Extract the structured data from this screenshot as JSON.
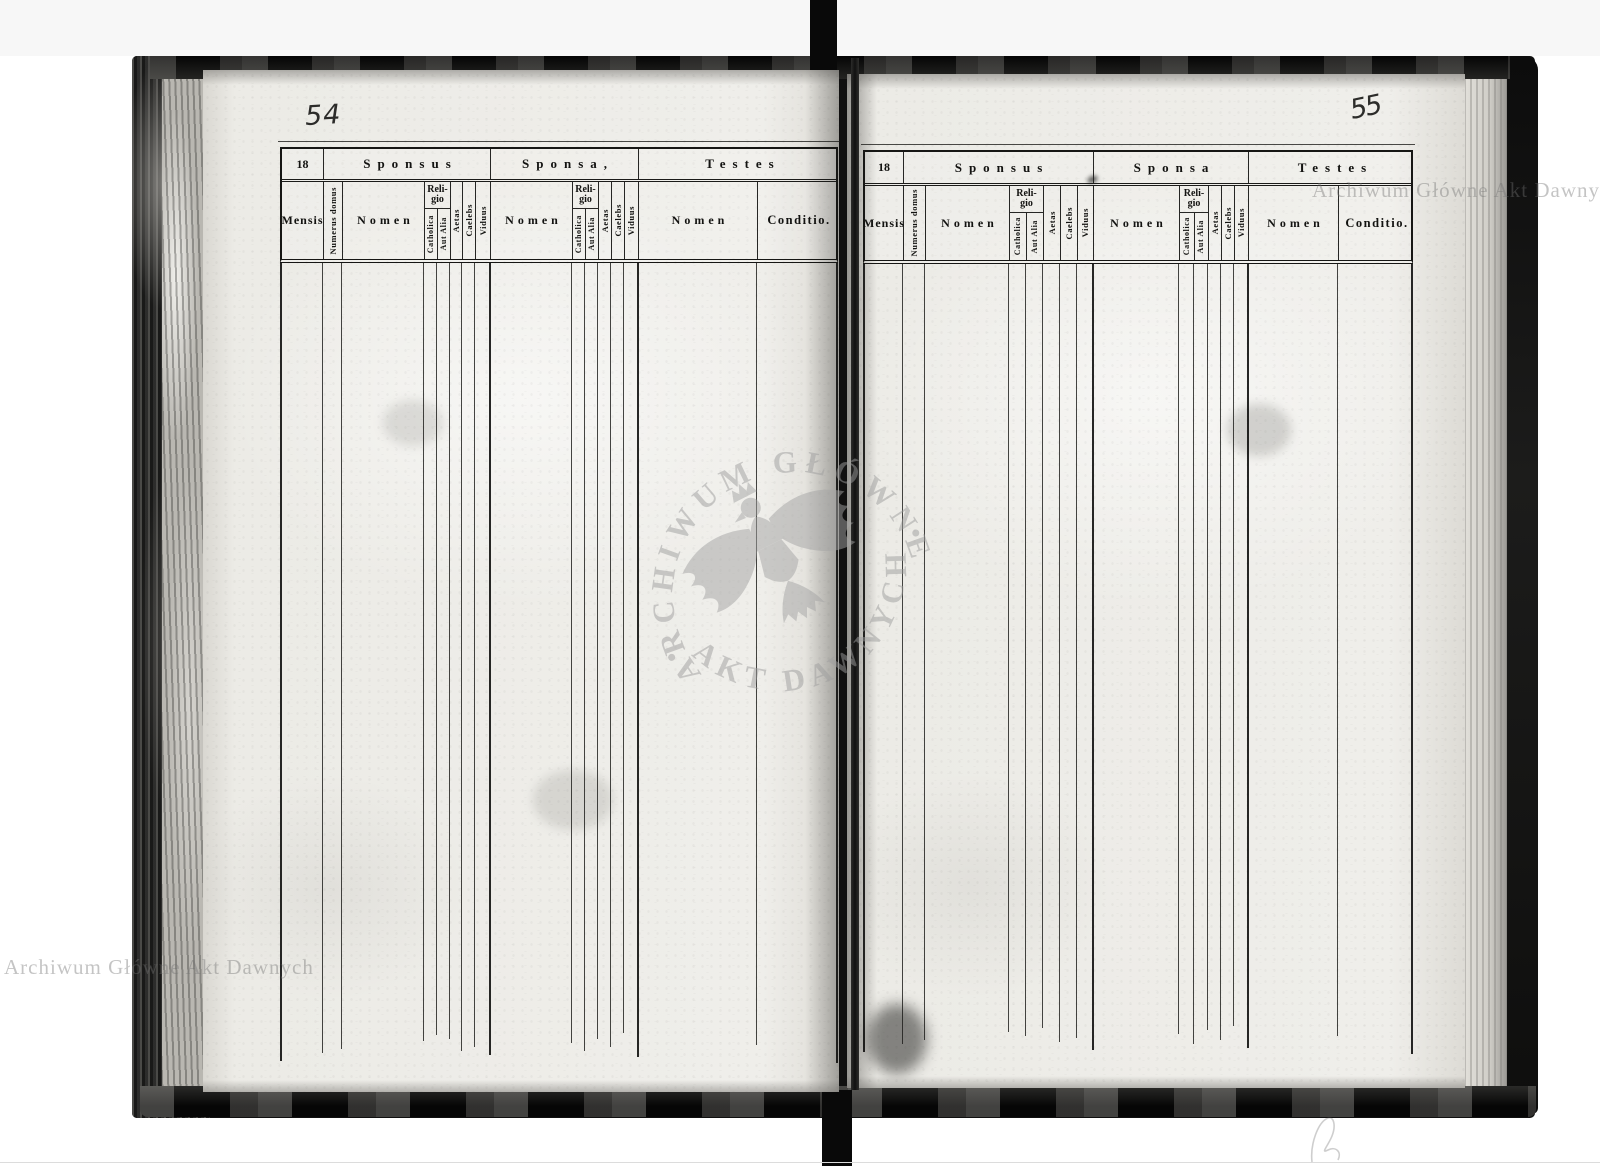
{
  "book": {
    "left_page": {
      "page_number": "54",
      "year_prefix": "18",
      "group_headers": {
        "sponsus": "Sponsus",
        "sponsa": "Sponsa,",
        "testes": "Testes"
      },
      "columns": {
        "mensis": "Mensis",
        "numerus_domus": "Numerus domus",
        "religio": {
          "line1": "Reli-",
          "line2": "gio"
        },
        "sponsus": {
          "nomen": "Nomen",
          "catholica": "Catholica",
          "aut_alia": "Aut Alia",
          "aetas": "Aetas",
          "caelebs": "Caelebs",
          "viduus": "Viduus"
        },
        "sponsa": {
          "nomen": "Nomen",
          "catholica": "Catholica",
          "aut_alia": "Aut Alia",
          "aetas": "Aetas",
          "caelebs": "Caelebs",
          "viduus": "Viduus"
        },
        "testes": {
          "nomen": "Nomen",
          "conditio": "Conditio."
        }
      }
    },
    "right_page": {
      "page_number": "55",
      "year_prefix": "18",
      "group_headers": {
        "sponsus": "Sponsus",
        "sponsa": "Sponsa",
        "testes": "Testes"
      },
      "columns": {
        "mensis": "Mensis",
        "numerus_domus": "Numerus domus",
        "religio": {
          "line1": "Reli-",
          "line2": "gio"
        },
        "sponsus": {
          "nomen": "Nomen",
          "catholica": "Catholica",
          "aut_alia": "Aut Alia",
          "aetas": "Aetas",
          "caelebs": "Caelebs",
          "viduus": "Viduus"
        },
        "sponsa": {
          "nomen": "Nomen",
          "catholica": "Catholica",
          "aut_alia": "Aut Alia",
          "aetas": "Aetas",
          "caelebs": "Caelebs",
          "viduus": "Viduus"
        },
        "testes": {
          "nomen": "Nomen",
          "conditio": "Conditio."
        }
      }
    }
  },
  "watermarks": {
    "corner_top_right": "Archiwum Główne Akt Dawnych",
    "corner_bottom_left": "Archiwum Główne Akt Dawnych",
    "seal_top": "ARCHIWUM GŁÓWNE",
    "seal_bottom": "AKT DAWNYCH",
    "seal_separator_left": "•",
    "seal_separator_right": "•"
  }
}
